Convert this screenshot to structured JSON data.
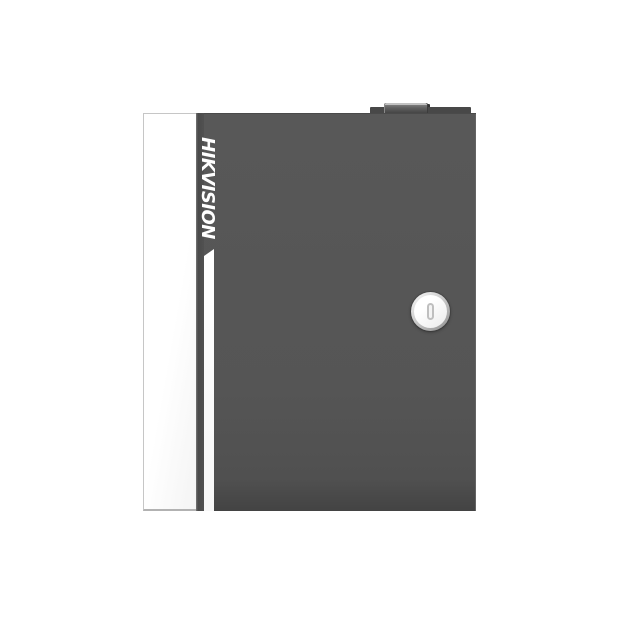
{
  "product": {
    "brand": "HIKVISION",
    "colors": {
      "background": "#ffffff",
      "door_gray": "#565656",
      "door_bottom_edge": "#434343",
      "side_panel_white": "#fdfdfd",
      "side_panel_border": "#c6c6c6",
      "accent_stripe_white": "#fbfbfb",
      "brand_text": "#ffffff",
      "hinge_knob_dark": "#454545",
      "lock_ring_gray": "#8e8e8e",
      "lock_face_white": "#fafafa"
    },
    "parts": {
      "top_knob": "hinge-knob",
      "side_panel": "white-side-panel",
      "door": "dark-front-door",
      "accent_stripe": "white-accent-stripe",
      "lock": "keyhole-cam-lock"
    }
  }
}
